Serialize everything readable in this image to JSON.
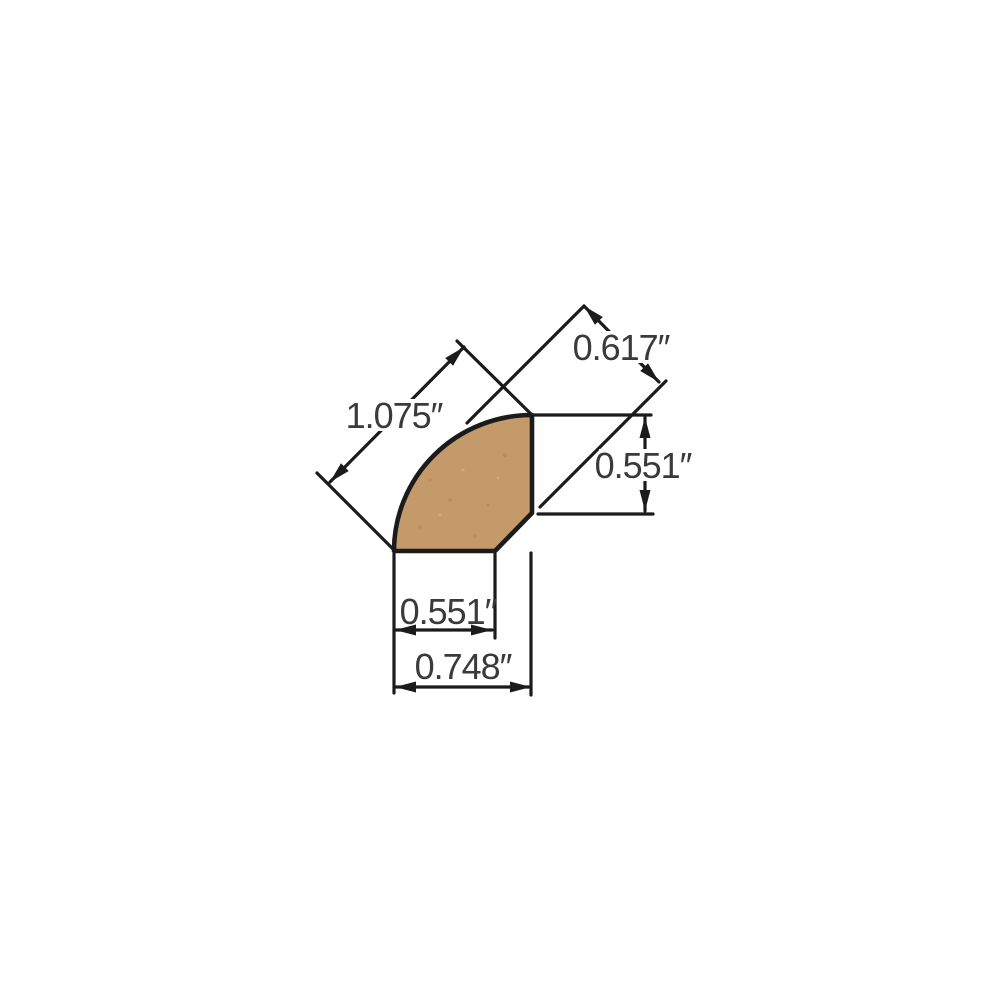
{
  "diagram": {
    "title": "quarter-round molding profile cross-section with dimensions",
    "units": "inches",
    "colors": {
      "wood_fill": "#c49a6b",
      "wood_speck_dark": "#a8825a",
      "wood_speck_light": "#dfc09a",
      "line": "#1b1b1b",
      "text": "#3a3a3a",
      "background": "#ffffff"
    },
    "dimensions": {
      "curved_face_diagonal": {
        "label": "1.075″",
        "value": 1.075
      },
      "chamfer_to_arc": {
        "label": "0.617″",
        "value": 0.617
      },
      "right_face_height": {
        "label": "0.551″",
        "value": 0.551
      },
      "bottom_face_width": {
        "label": "0.551″",
        "value": 0.551
      },
      "overall_width": {
        "label": "0.748″",
        "value": 0.748
      }
    }
  }
}
